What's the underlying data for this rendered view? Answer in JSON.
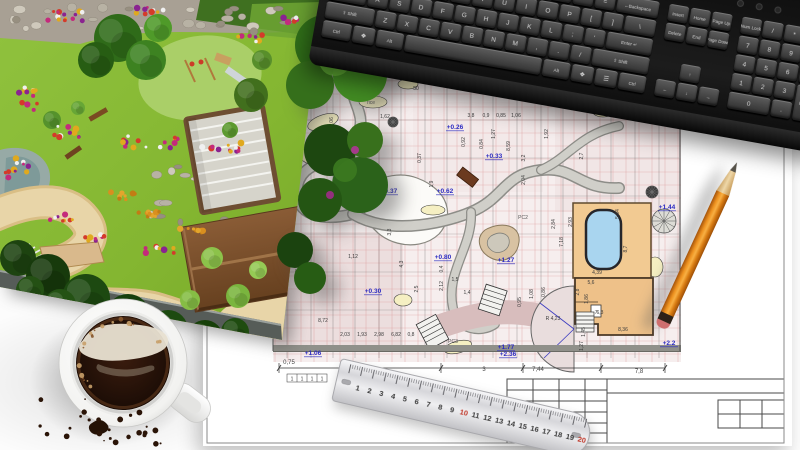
{
  "palette": {
    "grid_red": "#d98f8f",
    "dim_black": "#3c3c3c",
    "elev_blue": "#2b2bc2",
    "path_gray": "#8d8d88",
    "path_fill": "#d0cfc9",
    "bed_yellow": "#f5efc2",
    "pool_blue": "#a9d5ef",
    "deck_tan": "#f2ca92",
    "building_tan": "#eec189",
    "lawn_green": "#86b832",
    "pencil_orange": "#ee9220",
    "mauve": "#d8bdbd"
  },
  "keyboard": {
    "main_rows": [
      [
        [
          "`",
          1
        ],
        [
          "1",
          1
        ],
        [
          "2",
          1
        ],
        [
          "3",
          1
        ],
        [
          "4",
          1
        ],
        [
          "5",
          1
        ],
        [
          "6",
          1
        ],
        [
          "7",
          1
        ],
        [
          "8",
          1
        ],
        [
          "9",
          1
        ],
        [
          "0",
          1
        ],
        [
          "-",
          1
        ],
        [
          "=",
          1
        ],
        [
          "←Backspace",
          2
        ]
      ],
      [
        [
          "Tab",
          1.5
        ],
        [
          "Q",
          1
        ],
        [
          "W",
          1
        ],
        [
          "E",
          1
        ],
        [
          "R",
          1
        ],
        [
          "T",
          1
        ],
        [
          "Y",
          1
        ],
        [
          "U",
          1
        ],
        [
          "I",
          1
        ],
        [
          "O",
          1
        ],
        [
          "P",
          1
        ],
        [
          "[",
          1
        ],
        [
          "]",
          1
        ],
        [
          "\\",
          1.5
        ]
      ],
      [
        [
          "Caps Lock",
          1.8
        ],
        [
          "A",
          1
        ],
        [
          "S",
          1
        ],
        [
          "D",
          1
        ],
        [
          "F",
          1
        ],
        [
          "G",
          1
        ],
        [
          "H",
          1
        ],
        [
          "J",
          1
        ],
        [
          "K",
          1
        ],
        [
          "L",
          1
        ],
        [
          ";",
          1
        ],
        [
          "'",
          1
        ],
        [
          "Enter ↵",
          2.2
        ]
      ],
      [
        [
          "⇧ Shift",
          2.3
        ],
        [
          "Z",
          1
        ],
        [
          "X",
          1
        ],
        [
          "C",
          1
        ],
        [
          "V",
          1
        ],
        [
          "B",
          1
        ],
        [
          "N",
          1
        ],
        [
          "M",
          1
        ],
        [
          ",",
          1
        ],
        [
          ".",
          1
        ],
        [
          "/",
          1
        ],
        [
          "⇧ Shift",
          2.7
        ]
      ],
      [
        [
          "Ctrl",
          1.4
        ],
        [
          "❖",
          1.1
        ],
        [
          "Alt",
          1.3
        ],
        [
          "",
          6.4
        ],
        [
          "Alt",
          1.3
        ],
        [
          "❖",
          1.1
        ],
        [
          "☰",
          1.1
        ],
        [
          "Ctrl",
          1.3
        ]
      ]
    ],
    "nav_rows": [
      {
        "row": 0,
        "keys": [
          "Insert",
          "Home",
          "Page Up"
        ]
      },
      {
        "row": 1,
        "keys": [
          "Delete",
          "End",
          "Page Down"
        ]
      },
      {
        "row": 3,
        "keys": [
          "",
          "↑",
          ""
        ]
      },
      {
        "row": 4,
        "keys": [
          "←",
          "↓",
          "→"
        ]
      }
    ],
    "numpad": [
      {
        "t": "Num Lock",
        "c": 0,
        "r": 0
      },
      {
        "t": "/",
        "c": 1,
        "r": 0
      },
      {
        "t": "*",
        "c": 2,
        "r": 0
      },
      {
        "t": "-",
        "c": 3,
        "r": 0
      },
      {
        "t": "7",
        "c": 0,
        "r": 1
      },
      {
        "t": "8",
        "c": 1,
        "r": 1
      },
      {
        "t": "9",
        "c": 2,
        "r": 1
      },
      {
        "t": "+",
        "c": 3,
        "r": 1,
        "rs": 2
      },
      {
        "t": "4",
        "c": 0,
        "r": 2
      },
      {
        "t": "5",
        "c": 1,
        "r": 2
      },
      {
        "t": "6",
        "c": 2,
        "r": 2
      },
      {
        "t": "1",
        "c": 0,
        "r": 3
      },
      {
        "t": "2",
        "c": 1,
        "r": 3
      },
      {
        "t": "3",
        "c": 2,
        "r": 3
      },
      {
        "t": "Enter",
        "c": 3,
        "r": 3,
        "rs": 2
      },
      {
        "t": "0",
        "c": 0,
        "r": 4,
        "cs": 2
      },
      {
        "t": ".",
        "c": 2,
        "r": 4
      }
    ],
    "leds": 3
  },
  "ruler": {
    "numbers": [
      1,
      2,
      3,
      4,
      5,
      6,
      7,
      8,
      9,
      10,
      11,
      12,
      13,
      14,
      15,
      16,
      17,
      18,
      19,
      20
    ],
    "red_numbers": [
      10,
      20
    ]
  },
  "blueprint": {
    "elevation_labels": [
      {
        "t": "+0.02",
        "x": 160,
        "y": 70
      },
      {
        "t": "+0.26",
        "x": 252,
        "y": 67
      },
      {
        "t": "+0.33",
        "x": 291,
        "y": 96
      },
      {
        "t": "+0.37",
        "x": 186,
        "y": 131
      },
      {
        "t": "+0.62",
        "x": 242,
        "y": 131
      },
      {
        "t": "+0.80",
        "x": 240,
        "y": 197
      },
      {
        "t": "+1.27",
        "x": 303,
        "y": 200
      },
      {
        "t": "+0.30",
        "x": 170,
        "y": 231
      },
      {
        "t": "+1.06",
        "x": 110,
        "y": 293
      },
      {
        "t": "+1.77",
        "x": 303,
        "y": 287
      },
      {
        "t": "+2.36",
        "x": 305,
        "y": 294
      },
      {
        "t": "+2.2",
        "x": 466,
        "y": 283
      },
      {
        "t": "+1.44",
        "x": 464,
        "y": 147
      }
    ],
    "dimension_labels": [
      {
        "t": "1,62",
        "x": 182,
        "y": 56,
        "r": 0
      },
      {
        "t": "1,37",
        "x": 150,
        "y": 73,
        "r": 0
      },
      {
        "t": "2,34",
        "x": 160,
        "y": 92,
        "r": -90
      },
      {
        "t": "1,06",
        "x": 130,
        "y": 60,
        "r": -90
      },
      {
        "t": "3,8",
        "x": 268,
        "y": 55,
        "r": 0
      },
      {
        "t": "0,9",
        "x": 283,
        "y": 55,
        "r": 0
      },
      {
        "t": "0,85",
        "x": 298,
        "y": 55,
        "r": 0
      },
      {
        "t": "1,06",
        "x": 313,
        "y": 55,
        "r": 0
      },
      {
        "t": "0,92",
        "x": 262,
        "y": 80,
        "r": -90
      },
      {
        "t": "0,84",
        "x": 280,
        "y": 82,
        "r": -90
      },
      {
        "t": "8,59",
        "x": 307,
        "y": 84,
        "r": -90
      },
      {
        "t": "1,27",
        "x": 292,
        "y": 72,
        "r": -90
      },
      {
        "t": "3,2",
        "x": 322,
        "y": 96,
        "r": -90
      },
      {
        "t": "2,04",
        "x": 322,
        "y": 118,
        "r": -90
      },
      {
        "t": "1,92",
        "x": 345,
        "y": 72,
        "r": -90
      },
      {
        "t": "2,7",
        "x": 380,
        "y": 94,
        "r": -90
      },
      {
        "t": "2,84",
        "x": 352,
        "y": 162,
        "r": -90
      },
      {
        "t": "7,18",
        "x": 360,
        "y": 180,
        "r": -90
      },
      {
        "t": "2,93",
        "x": 369,
        "y": 160,
        "r": -90
      },
      {
        "t": "5,84",
        "x": 416,
        "y": 152,
        "r": -90
      },
      {
        "t": "8,7",
        "x": 424,
        "y": 187,
        "r": -90
      },
      {
        "t": "4,39",
        "x": 394,
        "y": 212,
        "r": 0
      },
      {
        "t": "5,6",
        "x": 388,
        "y": 222,
        "r": 0
      },
      {
        "t": "2,8",
        "x": 376,
        "y": 230,
        "r": -90
      },
      {
        "t": "1,86",
        "x": 385,
        "y": 237,
        "r": -90
      },
      {
        "t": "6,3",
        "x": 397,
        "y": 252,
        "r": 0
      },
      {
        "t": "R 4,23",
        "x": 350,
        "y": 258,
        "r": 0
      },
      {
        "t": "1,45",
        "x": 382,
        "y": 270,
        "r": -90
      },
      {
        "t": "8,36",
        "x": 420,
        "y": 269,
        "r": 0
      },
      {
        "t": "1,27",
        "x": 380,
        "y": 284,
        "r": -90
      },
      {
        "t": "2,03",
        "x": 142,
        "y": 274,
        "r": 0
      },
      {
        "t": "1,93",
        "x": 159,
        "y": 274,
        "r": 0
      },
      {
        "t": "2,98",
        "x": 176,
        "y": 274,
        "r": 0
      },
      {
        "t": "6,82",
        "x": 193,
        "y": 274,
        "r": 0
      },
      {
        "t": "0,8",
        "x": 208,
        "y": 274,
        "r": 0
      },
      {
        "t": "8,72",
        "x": 120,
        "y": 260,
        "r": 0
      },
      {
        "t": "3,3",
        "x": 188,
        "y": 170,
        "r": -90
      },
      {
        "t": "4,3",
        "x": 200,
        "y": 202,
        "r": -90
      },
      {
        "t": "1,12",
        "x": 150,
        "y": 196,
        "r": 0
      },
      {
        "t": "2,5",
        "x": 215,
        "y": 227,
        "r": -90
      },
      {
        "t": "1,4",
        "x": 264,
        "y": 232,
        "r": 0
      },
      {
        "t": "1,5",
        "x": 252,
        "y": 219,
        "r": 0
      },
      {
        "t": "0,95",
        "x": 318,
        "y": 240,
        "r": -90
      },
      {
        "t": "1,08",
        "x": 330,
        "y": 232,
        "r": -90
      },
      {
        "t": "0,86",
        "x": 342,
        "y": 230,
        "r": -90
      },
      {
        "t": "2,47",
        "x": 80,
        "y": 152,
        "r": -90
      },
      {
        "t": "3,47",
        "x": 80,
        "y": 120,
        "r": -90
      },
      {
        "t": "2,03",
        "x": 80,
        "y": 182,
        "r": -90
      },
      {
        "t": "1,9",
        "x": 230,
        "y": 122,
        "r": -90
      },
      {
        "t": "0,37",
        "x": 218,
        "y": 96,
        "r": -90
      },
      {
        "t": "50",
        "x": 213,
        "y": 28,
        "r": 0
      },
      {
        "t": "0,4",
        "x": 240,
        "y": 207,
        "r": -90
      },
      {
        "t": "2,12",
        "x": 240,
        "y": 224,
        "r": -90
      },
      {
        "t": "3,17",
        "x": 96,
        "y": 212,
        "r": -90
      }
    ],
    "bottom_dims": [
      {
        "t": "0,75",
        "x": 86,
        "y": 302
      },
      {
        "t": "8,04",
        "x": 146,
        "y": 306
      },
      {
        "t": "3",
        "x": 281,
        "y": 309
      },
      {
        "t": "7,44",
        "x": 335,
        "y": 309
      },
      {
        "t": "7,8",
        "x": 436,
        "y": 311
      }
    ],
    "ones_row": [
      "1",
      "1",
      "1",
      "1"
    ],
    "misc_labels": [
      {
        "t": "7",
        "x": 393,
        "y": 252
      },
      {
        "t": "PC2",
        "x": 320,
        "y": 157
      },
      {
        "t": "PC3",
        "x": 250,
        "y": 281
      },
      {
        "t": "rice",
        "x": 168,
        "y": 42
      }
    ],
    "tree_symbols": [
      [
        449,
        130,
        6,
        1
      ],
      [
        461,
        159,
        12,
        0
      ],
      [
        190,
        60,
        5,
        1
      ]
    ],
    "grid_step": 13,
    "vlines": [
      84,
      108,
      130,
      152,
      176,
      198,
      222,
      244,
      268,
      290,
      314,
      338,
      360,
      384,
      408,
      432,
      456
    ],
    "hlines": [
      18,
      58,
      96,
      134,
      172,
      210,
      248
    ],
    "dim_ticks": [
      76,
      142,
      238,
      320,
      398,
      462
    ]
  },
  "garden": {
    "trees": [
      [
        118,
        38,
        24,
        "#2f6b19"
      ],
      [
        146,
        60,
        20,
        "#3d8221"
      ],
      [
        96,
        60,
        18,
        "#275d13"
      ],
      [
        158,
        28,
        14,
        "#4f9a29"
      ],
      [
        251,
        95,
        17,
        "#416f1d"
      ],
      [
        262,
        60,
        10,
        "#588f2b"
      ],
      [
        18,
        258,
        18,
        "#1d4310"
      ],
      [
        48,
        276,
        22,
        "#173a0c"
      ],
      [
        86,
        298,
        24,
        "#1d4911"
      ],
      [
        128,
        316,
        22,
        "#16400c"
      ],
      [
        168,
        330,
        20,
        "#1d4a10"
      ],
      [
        205,
        338,
        18,
        "#174009"
      ],
      [
        60,
        305,
        16,
        "#245214"
      ],
      [
        105,
        330,
        15,
        "#1a430d"
      ],
      [
        235,
        332,
        14,
        "#1f4c10"
      ],
      [
        30,
        290,
        14,
        "#245014"
      ],
      [
        212,
        258,
        11,
        "#8cc24a"
      ],
      [
        238,
        296,
        12,
        "#7ab53e"
      ],
      [
        258,
        270,
        9,
        "#95ca55"
      ],
      [
        190,
        300,
        10,
        "#86bd45"
      ],
      [
        52,
        120,
        9,
        "#55922c"
      ],
      [
        78,
        108,
        7,
        "#67a636"
      ],
      [
        230,
        130,
        8,
        "#5d9a2f"
      ]
    ],
    "flower_palettes": [
      [
        "#c42a7c",
        "#e0a91e",
        "#d43b2a",
        "#8a2390",
        "#f0f0f0"
      ],
      [
        "#d98f1f",
        "#e3a52c",
        "#c27c14"
      ]
    ],
    "flower_beds": [
      [
        60,
        16,
        14,
        46,
        10,
        0
      ],
      [
        150,
        10,
        10,
        40,
        8,
        0
      ],
      [
        28,
        98,
        12,
        20,
        26,
        0
      ],
      [
        66,
        132,
        10,
        26,
        12,
        0
      ],
      [
        18,
        170,
        12,
        30,
        30,
        0
      ],
      [
        150,
        142,
        16,
        56,
        12,
        0
      ],
      [
        222,
        148,
        12,
        40,
        10,
        0
      ],
      [
        60,
        218,
        8,
        26,
        8,
        0
      ],
      [
        96,
        238,
        8,
        22,
        8,
        0
      ],
      [
        250,
        38,
        8,
        26,
        8,
        0
      ],
      [
        292,
        20,
        6,
        18,
        6,
        0
      ],
      [
        160,
        250,
        8,
        30,
        8,
        0
      ],
      [
        120,
        196,
        9,
        30,
        8,
        1
      ],
      [
        150,
        215,
        9,
        30,
        8,
        1
      ],
      [
        190,
        232,
        8,
        26,
        8,
        1
      ]
    ],
    "stone_strips": [
      [
        8,
        6,
        300,
        26,
        26
      ],
      [
        150,
        165,
        80,
        60,
        18
      ],
      [
        0,
        196,
        50,
        24,
        8
      ]
    ]
  },
  "coffee": {
    "bubble_count": 20,
    "crumb_count": 26
  }
}
